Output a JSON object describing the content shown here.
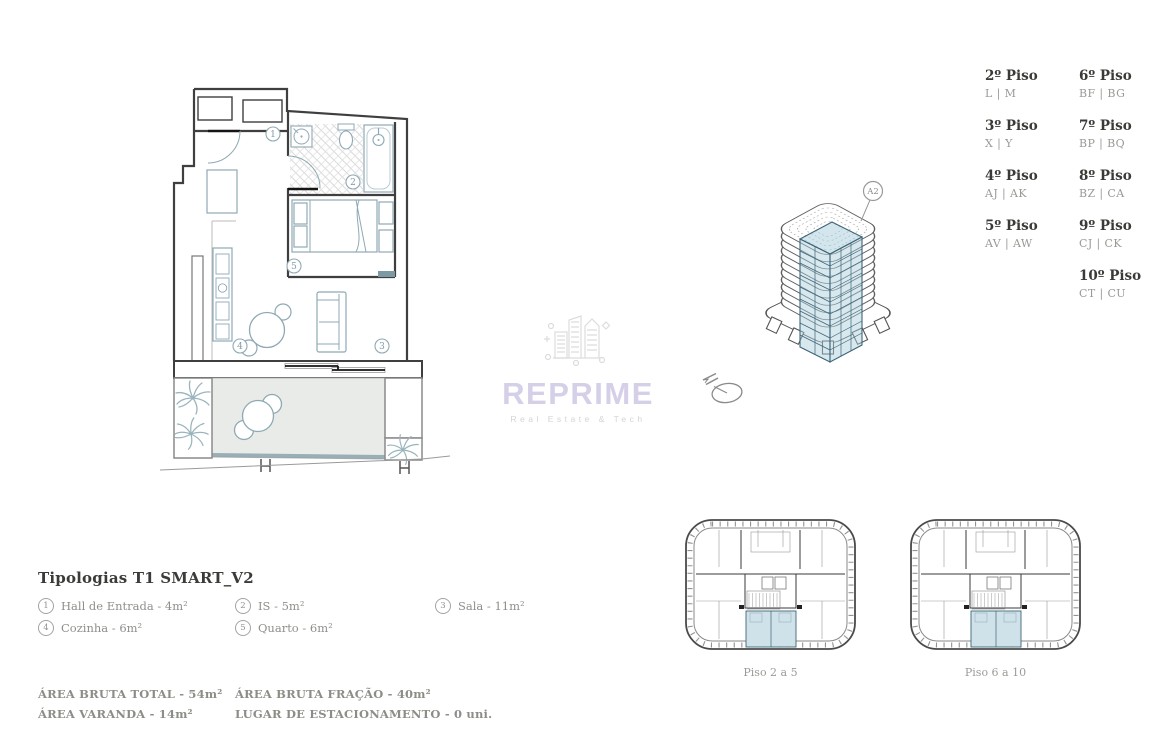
{
  "floors_legend": {
    "column1": [
      {
        "label": "2º Piso",
        "codes": "L | M"
      },
      {
        "label": "3º Piso",
        "codes": "X | Y"
      },
      {
        "label": "4º Piso",
        "codes": "AJ | AK"
      },
      {
        "label": "5º Piso",
        "codes": "AV | AW"
      }
    ],
    "column2": [
      {
        "label": "6º Piso",
        "codes": "BF | BG"
      },
      {
        "label": "7º Piso",
        "codes": "BP | BQ"
      },
      {
        "label": "8º Piso",
        "codes": "BZ | CA"
      },
      {
        "label": "9º Piso",
        "codes": "CJ | CK"
      },
      {
        "label": "10º Piso",
        "codes": "CT | CU"
      }
    ]
  },
  "building": {
    "unit_label": "A2"
  },
  "watermark": {
    "brand": "REPRIME",
    "tagline": "Real Estate & Tech"
  },
  "typology": {
    "title": "Tipologias T1 SMART_V2",
    "items": [
      {
        "num": "1",
        "label": "Hall de Entrada - 4m²"
      },
      {
        "num": "2",
        "label": "IS - 5m²"
      },
      {
        "num": "3",
        "label": "Sala - 11m²"
      },
      {
        "num": "4",
        "label": "Cozinha - 6m²"
      },
      {
        "num": "5",
        "label": "Quarto - 6m²"
      }
    ]
  },
  "areas": {
    "bruta_total": "ÁREA BRUTA TOTAL - 54m²",
    "bruta_fracao": "ÁREA BRUTA FRAÇÃO - 40m²",
    "varanda": "ÁREA VARANDA - 14m²",
    "estacionamento": "LUGAR DE ESTACIONAMENTO - 0 uni."
  },
  "floor_plates": [
    {
      "caption": "Piso 2 a 5"
    },
    {
      "caption": "Piso 6 a 10"
    }
  ],
  "colors": {
    "highlight_blue": "#cfe2ea",
    "teal_line": "#3e6577",
    "furniture_teal": "#8fa9b4",
    "wall_dark": "#3f3f3f",
    "text_dark": "#3a3a36",
    "text_gray": "#98968f",
    "watermark_purple": "#d6cfe8",
    "balcony_fill": "#e9ebe8"
  }
}
